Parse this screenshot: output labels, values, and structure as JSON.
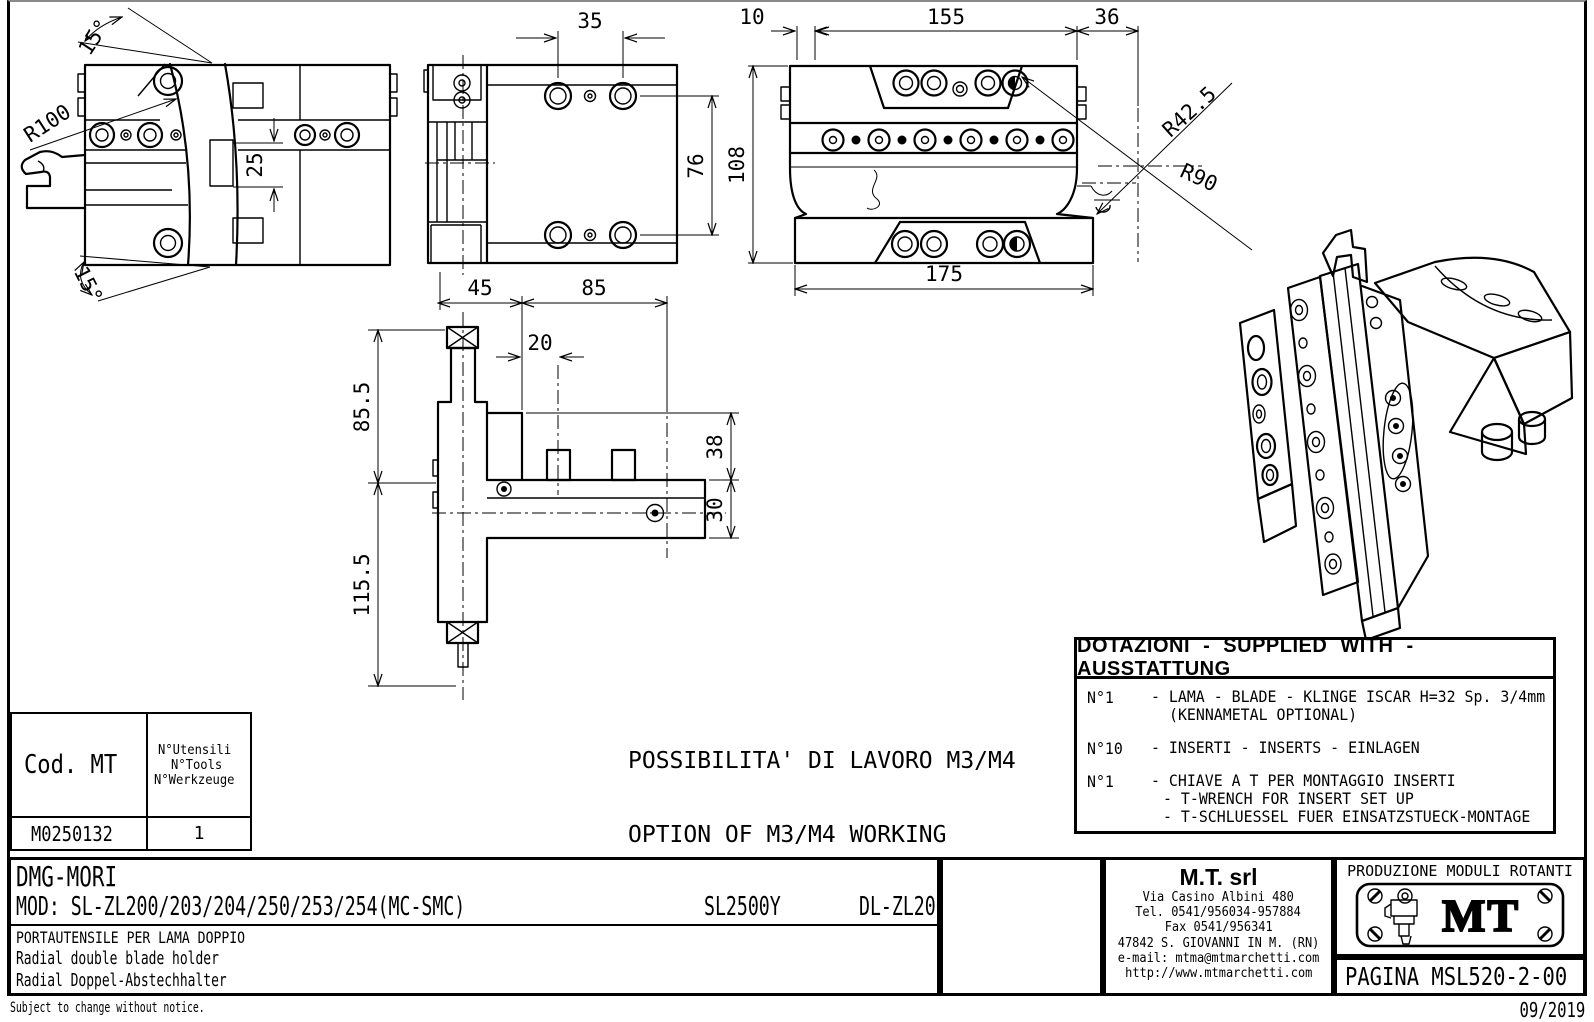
{
  "dims": {
    "side": {
      "angle_top": "15°",
      "radius_blade": "R100",
      "slot_height": "25",
      "angle_bottom": "15°"
    },
    "top": {
      "hole_spacing": "35",
      "row_spacing": "76"
    },
    "front": {
      "d10": "10",
      "d155": "155",
      "d36": "36",
      "d108": "108",
      "d175": "175",
      "r1": "R42.5",
      "r2": "R90"
    },
    "section": {
      "d45": "45",
      "d85": "85",
      "d20": "20",
      "d85_5": "85.5",
      "d115_5": "115.5",
      "d38": "38",
      "d30": "30"
    }
  },
  "working_note": {
    "line1": "POSSIBILITA' DI LAVORO M3/M4",
    "line2": "OPTION OF M3/M4 WORKING",
    "line3": "ARBEITSMÖGLICHKGIT M3/M4"
  },
  "cod_table": {
    "header_code": "Cod. MT",
    "header_tools_l1": "N°Utensili",
    "header_tools_l2": "N°Tools",
    "header_tools_l3": "N°Werkzeuge",
    "code": "M0250132",
    "tools": "1"
  },
  "dotazioni": {
    "title": "DOTAZIONI - SUPPLIED WITH - AUSSTATTUNG",
    "items": [
      {
        "qty": "N°1",
        "lines": [
          "- LAMA - BLADE - KLINGE ISCAR H=32 Sp. 3/4mm",
          "(KENNAMETAL OPTIONAL)"
        ]
      },
      {
        "qty": "N°10",
        "lines": [
          "- INSERTI - INSERTS - EINLAGEN"
        ]
      },
      {
        "qty": "N°1",
        "lines": [
          "- CHIAVE A T PER MONTAGGIO INSERTI",
          "- T-WRENCH FOR INSERT SET UP",
          "- T-SCHLUESSEL FUER EINSATZSTUECK-MONTAGE"
        ]
      }
    ]
  },
  "title_block": {
    "customer": "DMG-MORI",
    "mod_label": "MOD: SL-ZL200/203/204/250/253/254(MC-SMC)",
    "mod_2": "SL2500Y",
    "mod_3": "DL-ZL200/250(MC)",
    "desc_it": "PORTAUTENSILE PER LAMA DOPPIO",
    "desc_en": "Radial double blade holder",
    "desc_de": "Radial Doppel-Abstechhalter",
    "company_name": "M.T. srl",
    "company_address": "Via Casino Albini 480",
    "company_tel": "Tel. 0541/956034-957884",
    "company_fax": "Fax 0541/956341",
    "company_city": "47842 S. GIOVANNI IN M. (RN)",
    "company_email": "e-mail: mtma@mtmarchetti.com",
    "company_web": "http://www.mtmarchetti.com",
    "production": "PRODUZIONE MODULI ROTANTI",
    "logo_text": "MT",
    "page": "PAGINA MSL520-2-00"
  },
  "footer": {
    "notice": "Subject to change without notice.",
    "date": "09/2019"
  }
}
